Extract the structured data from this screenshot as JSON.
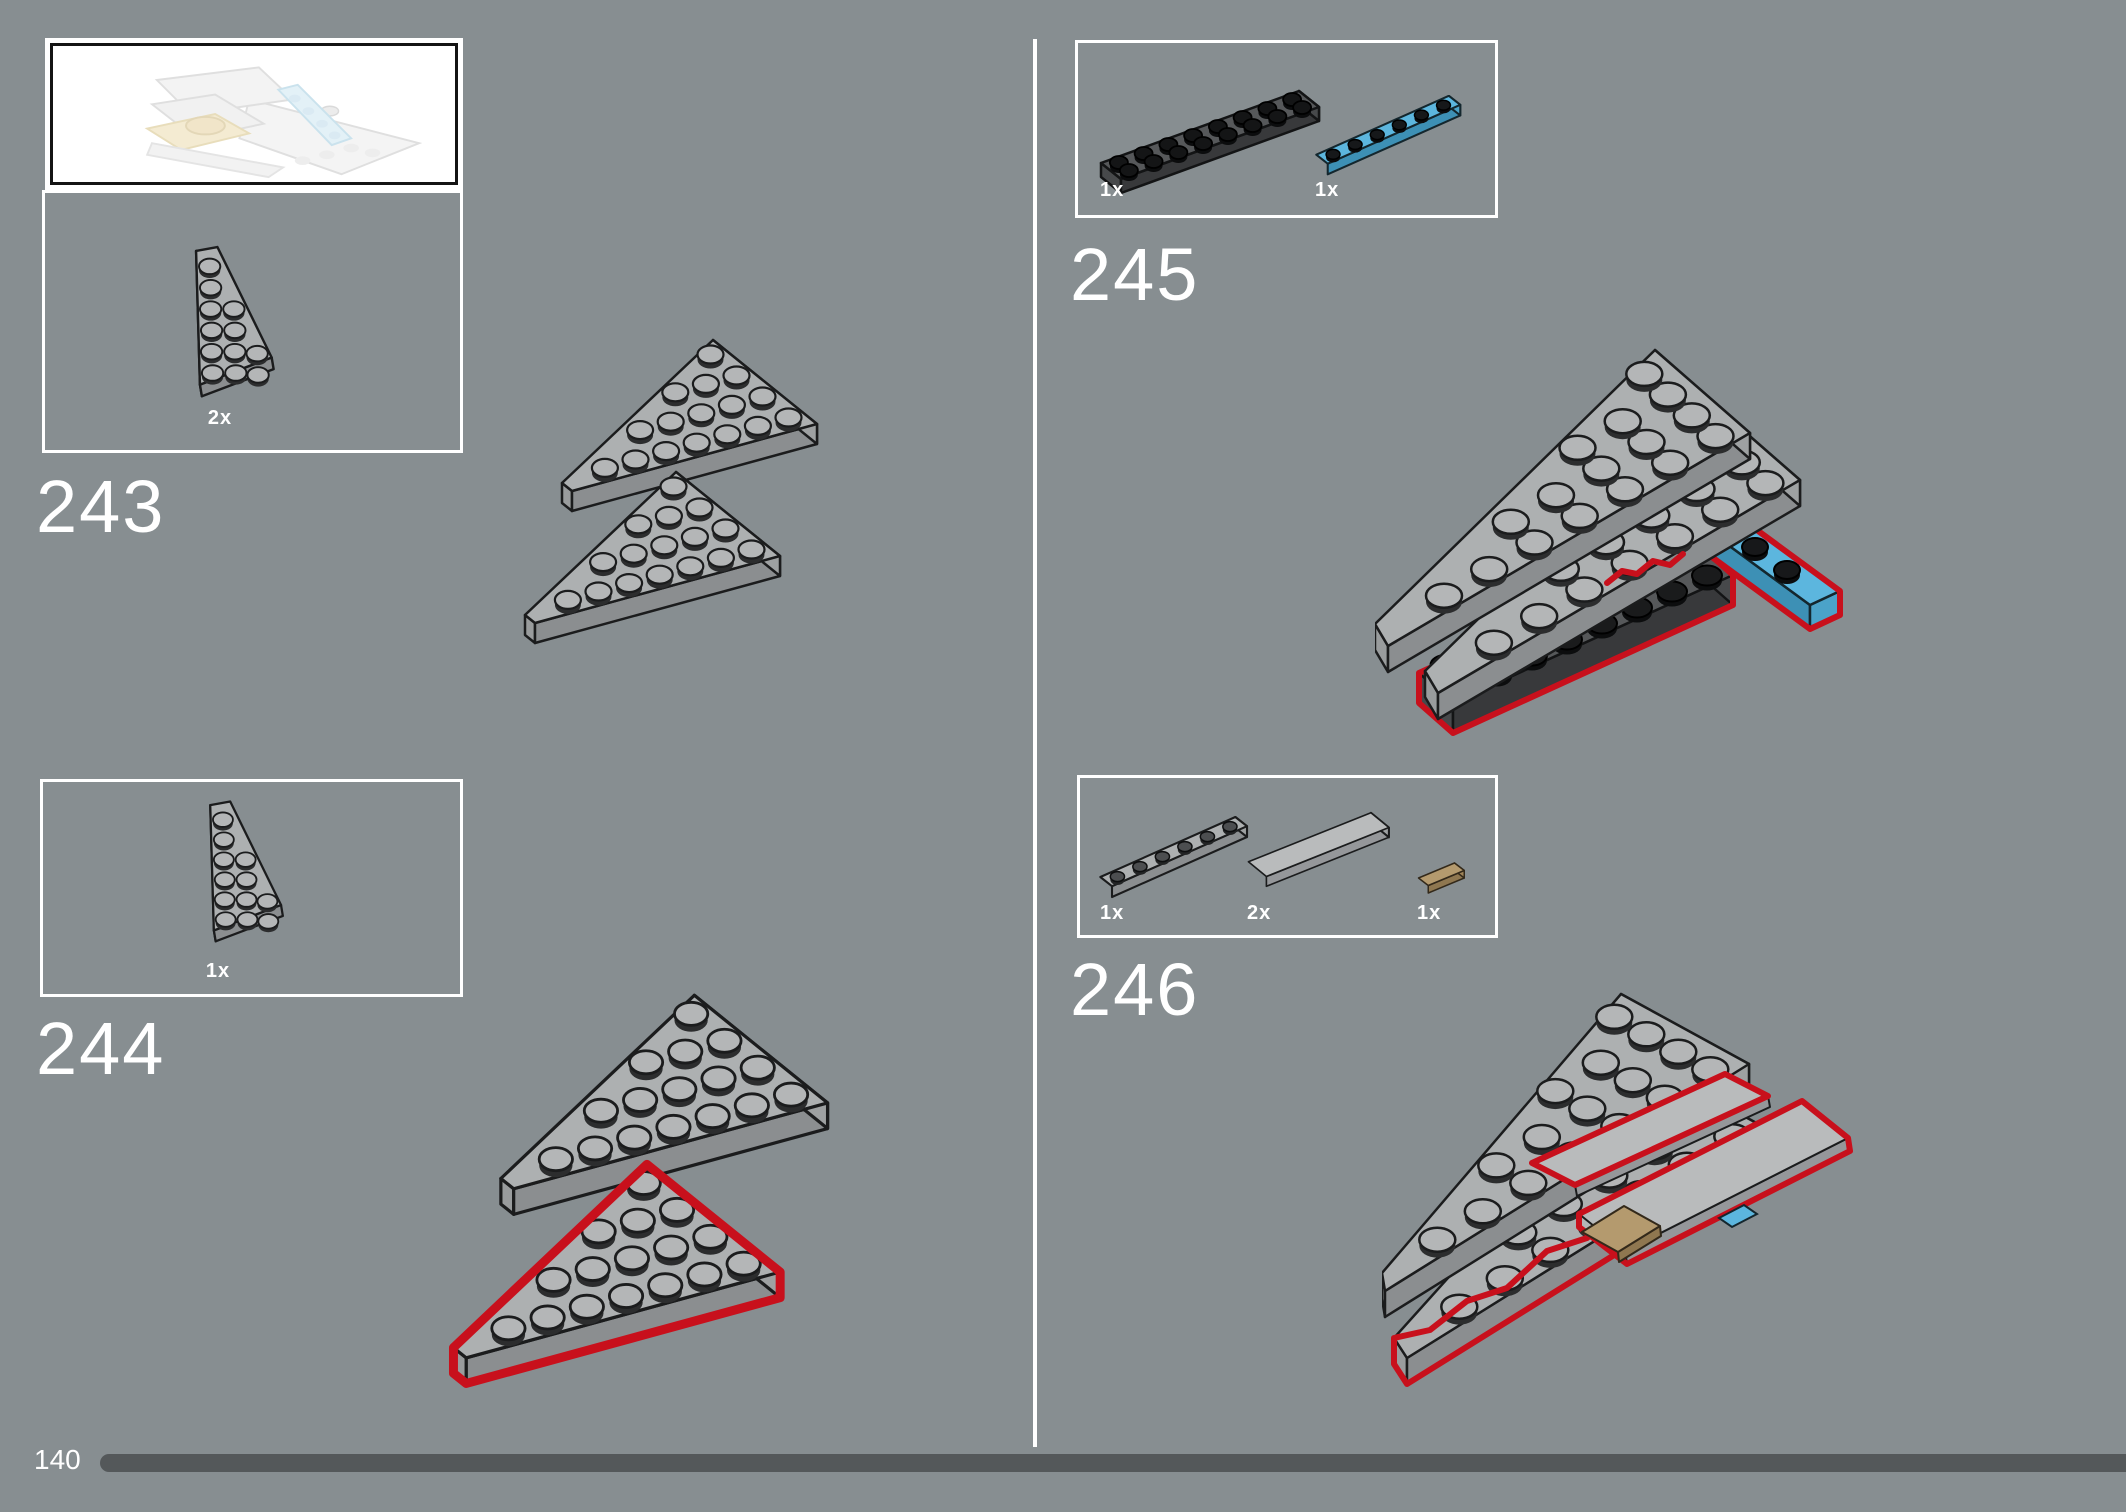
{
  "page": {
    "number": "140",
    "background": "#878e91",
    "divider_color": "#ffffff",
    "progress_color": "#54585a",
    "highlight_color": "#c8101c"
  },
  "preview": {
    "description": "faded-preview-of-partial-model"
  },
  "steps": [
    {
      "number": "243",
      "parts": [
        {
          "qty": "2x",
          "piece": "wedge-plate-6x4-right-light-gray",
          "color": "#b4b6b7"
        }
      ]
    },
    {
      "number": "244",
      "parts": [
        {
          "qty": "1x",
          "piece": "wedge-plate-6x4-right-light-gray",
          "color": "#b4b6b7"
        }
      ]
    },
    {
      "number": "245",
      "parts": [
        {
          "qty": "1x",
          "piece": "plate-2x8-dark-gray",
          "color": "#56585a"
        },
        {
          "qty": "1x",
          "piece": "plate-1x6-medium-azure",
          "color": "#5cb6de"
        }
      ]
    },
    {
      "number": "246",
      "parts": [
        {
          "qty": "1x",
          "piece": "plate-1x6-light-gray",
          "color": "#b4b6b7"
        },
        {
          "qty": "2x",
          "piece": "tile-2x6-light-gray",
          "color": "#b9bbbc"
        },
        {
          "qty": "1x",
          "piece": "tile-1x2-dark-tan",
          "color": "#b49a6e"
        }
      ]
    }
  ]
}
